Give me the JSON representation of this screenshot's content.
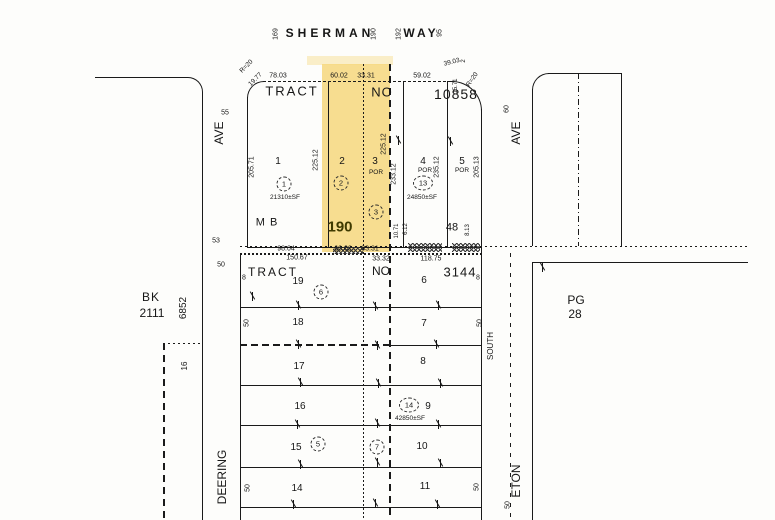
{
  "colors": {
    "highlight": "#F6D77C",
    "line": "#1A1A1A",
    "paper": "#FDFDFB",
    "highlight_number": "#3F3A00"
  },
  "map": {
    "street_labels": [
      {
        "n": "street-sherman",
        "t": "SHERMAN",
        "x": 330,
        "y": 33,
        "s": 12,
        "w": 1,
        "ls": 4
      },
      {
        "n": "street-way",
        "t": "WAY",
        "x": 421,
        "y": 33,
        "s": 12,
        "w": 1,
        "ls": 3
      },
      {
        "n": "address-169",
        "t": "169",
        "x": 276,
        "y": 34,
        "r": -90,
        "s": 7
      },
      {
        "n": "address-190",
        "t": "190",
        "x": 374,
        "y": 34,
        "r": -90,
        "s": 7
      },
      {
        "n": "address-192",
        "t": "192",
        "x": 399,
        "y": 34,
        "r": -90,
        "s": 7
      },
      {
        "n": "address-95",
        "t": "95",
        "x": 440,
        "y": 33,
        "r": -90,
        "s": 7
      },
      {
        "n": "street-ave-left",
        "t": "AVE",
        "x": 219,
        "y": 133,
        "r": -90,
        "s": 12
      },
      {
        "n": "street-width-55",
        "t": "55",
        "x": 225,
        "y": 113,
        "s": 7
      },
      {
        "n": "street-deering",
        "t": "DEERING",
        "x": 222,
        "y": 477,
        "r": -90,
        "s": 12
      },
      {
        "n": "street-ave-right",
        "t": "AVE",
        "x": 516,
        "y": 133,
        "r": -90,
        "s": 12
      },
      {
        "n": "street-width-60",
        "t": "60",
        "x": 507,
        "y": 109,
        "r": -90,
        "s": 7
      },
      {
        "n": "street-eton",
        "t": "ETON",
        "x": 516,
        "y": 481,
        "r": -90,
        "s": 12
      },
      {
        "n": "label-south",
        "t": "SOUTH",
        "x": 491,
        "y": 346,
        "r": -90,
        "s": 8
      },
      {
        "n": "street-width-50-eton",
        "t": "50",
        "x": 508,
        "y": 505,
        "r": -90,
        "s": 7
      }
    ],
    "upper_tract_labels": [
      {
        "n": "upper-tract-word",
        "t": "TRACT",
        "x": 292,
        "y": 91,
        "s": 13,
        "ls": 2
      },
      {
        "n": "upper-tract-no",
        "t": "NO",
        "x": 382,
        "y": 92,
        "s": 13,
        "ls": 1
      },
      {
        "n": "upper-tract-number",
        "t": "10858",
        "x": 456,
        "y": 94,
        "s": 14,
        "ls": 1
      },
      {
        "n": "dim-78-03",
        "t": "78.03",
        "x": 278,
        "y": 76
      },
      {
        "n": "dim-60-02-top",
        "t": "60.02",
        "x": 339,
        "y": 76
      },
      {
        "n": "dim-33-31-top",
        "t": "33.31",
        "x": 366,
        "y": 76
      },
      {
        "n": "dim-59-02",
        "t": "59.02",
        "x": 422,
        "y": 76
      },
      {
        "n": "dim-39-03",
        "t": "39.03",
        "x": 452,
        "y": 63,
        "r": -14,
        "s": 6.5
      },
      {
        "n": "dim-2",
        "t": "2",
        "x": 464,
        "y": 61,
        "r": -90,
        "s": 6
      },
      {
        "n": "dim-r20-ne",
        "t": "R=20",
        "x": 473,
        "y": 80,
        "r": -55,
        "s": 6.5
      },
      {
        "n": "dim-r20-nw",
        "t": "R=20",
        "x": 247,
        "y": 67,
        "r": -45,
        "s": 6.5
      },
      {
        "n": "dim-19-77",
        "t": "19.77",
        "x": 256,
        "y": 80,
        "r": -45,
        "s": 6.5
      },
      {
        "n": "dim-15-71",
        "t": "15.71",
        "x": 456,
        "y": 86,
        "r": -90,
        "s": 6
      },
      {
        "n": "parcel-1-number",
        "t": "1",
        "x": 278,
        "y": 162,
        "s": 10
      },
      {
        "n": "parcel-1-area",
        "t": "21310±SF",
        "x": 285,
        "y": 198,
        "s": 6.5
      },
      {
        "n": "parcel-2-number",
        "t": "2",
        "x": 342,
        "y": 162,
        "s": 10
      },
      {
        "n": "parcel-3-number",
        "t": "3",
        "x": 375,
        "y": 162,
        "s": 10
      },
      {
        "n": "parcel-3-por",
        "t": "POR",
        "x": 376,
        "y": 173,
        "s": 6.5
      },
      {
        "n": "parcel-4-number",
        "t": "4",
        "x": 423,
        "y": 162,
        "s": 10
      },
      {
        "n": "parcel-4-por",
        "t": "POR",
        "x": 425,
        "y": 171,
        "s": 6.5
      },
      {
        "n": "parcel-4-area",
        "t": "24850±SF",
        "x": 422,
        "y": 198,
        "s": 6.5
      },
      {
        "n": "parcel-5-number",
        "t": "5",
        "x": 462,
        "y": 162,
        "s": 10
      },
      {
        "n": "parcel-5-por",
        "t": "POR",
        "x": 462,
        "y": 171,
        "s": 6.5
      },
      {
        "n": "dim-205-71",
        "t": "205.71",
        "x": 252,
        "y": 167,
        "r": -90
      },
      {
        "n": "dim-225-12-a",
        "t": "225.12",
        "x": 316,
        "y": 160,
        "r": -90
      },
      {
        "n": "dim-225-12-b",
        "t": "225.12",
        "x": 384,
        "y": 144,
        "r": -90
      },
      {
        "n": "dim-233-12",
        "t": "233.12",
        "x": 394,
        "y": 174,
        "r": -90
      },
      {
        "n": "dim-235-12",
        "t": "235.12",
        "x": 437,
        "y": 167,
        "r": -90
      },
      {
        "n": "dim-205-13",
        "t": "205.13",
        "x": 477,
        "y": 167,
        "r": -90
      },
      {
        "n": "dim-10-71",
        "t": "10.71",
        "x": 397,
        "y": 231,
        "r": -90,
        "s": 6
      },
      {
        "n": "dim-6-12",
        "t": "6.12",
        "x": 406,
        "y": 229,
        "r": -90,
        "s": 6
      },
      {
        "n": "dim-8-13",
        "t": "8.13",
        "x": 468,
        "y": 230,
        "r": -90,
        "s": 6
      },
      {
        "n": "map-book-page-190",
        "t": "190",
        "x": 340,
        "y": 227,
        "s": 15,
        "w": 1,
        "c": "#3F3A00"
      },
      {
        "n": "map-book-label",
        "t": "M B",
        "x": 267,
        "y": 223,
        "s": 11,
        "ls": 1
      },
      {
        "n": "num-48",
        "t": "48",
        "x": 452,
        "y": 228,
        "s": 11
      },
      {
        "n": "dim-98-04",
        "t": "98.04",
        "x": 286,
        "y": 249
      },
      {
        "n": "dim-60-02-bottom",
        "t": "60.02",
        "x": 343,
        "y": 249
      },
      {
        "n": "dim-33-31-bottom",
        "t": "33.31",
        "x": 370,
        "y": 249
      },
      {
        "n": "num-53",
        "t": "53",
        "x": 216,
        "y": 241,
        "s": 7
      },
      {
        "n": "num-50-left",
        "t": "50",
        "x": 221,
        "y": 265,
        "s": 7
      }
    ],
    "lower_tract_labels": [
      {
        "n": "lower-tract-word",
        "t": "TRACT",
        "x": 273,
        "y": 272,
        "s": 12,
        "ls": 2
      },
      {
        "n": "lower-tract-no",
        "t": "NO",
        "x": 381,
        "y": 271,
        "s": 12
      },
      {
        "n": "lower-tract-number",
        "t": "3144",
        "x": 460,
        "y": 272,
        "s": 13,
        "ls": 1
      },
      {
        "n": "dim-150-67",
        "t": "150.67",
        "x": 297,
        "y": 258
      },
      {
        "n": "dim-33-32",
        "t": "33.32",
        "x": 381,
        "y": 259
      },
      {
        "n": "dim-118-75",
        "t": "118.75",
        "x": 431,
        "y": 259
      },
      {
        "n": "lot-19",
        "t": "19",
        "x": 298,
        "y": 282,
        "s": 10
      },
      {
        "n": "lot-18",
        "t": "18",
        "x": 298,
        "y": 323,
        "s": 10
      },
      {
        "n": "lot-17",
        "t": "17",
        "x": 299,
        "y": 367,
        "s": 10
      },
      {
        "n": "lot-16",
        "t": "16",
        "x": 300,
        "y": 407,
        "s": 10
      },
      {
        "n": "lot-15",
        "t": "15",
        "x": 296,
        "y": 448,
        "s": 10
      },
      {
        "n": "lot-14",
        "t": "14",
        "x": 297,
        "y": 489,
        "s": 10
      },
      {
        "n": "lot-6",
        "t": "6",
        "x": 424,
        "y": 281,
        "s": 10
      },
      {
        "n": "lot-7",
        "t": "7",
        "x": 424,
        "y": 324,
        "s": 10
      },
      {
        "n": "lot-8",
        "t": "8",
        "x": 423,
        "y": 362,
        "s": 10
      },
      {
        "n": "lot-9",
        "t": "9",
        "x": 428,
        "y": 407,
        "s": 10
      },
      {
        "n": "lot-9-area",
        "t": "42850±SF",
        "x": 410,
        "y": 419,
        "s": 6.5
      },
      {
        "n": "lot-10",
        "t": "10",
        "x": 422,
        "y": 447,
        "s": 10
      },
      {
        "n": "lot-11",
        "t": "11",
        "x": 425,
        "y": 487,
        "s": 10
      },
      {
        "n": "edge-8-left",
        "t": "8",
        "x": 244,
        "y": 278,
        "s": 7
      },
      {
        "n": "edge-8-right",
        "t": "8",
        "x": 478,
        "y": 278,
        "s": 7
      },
      {
        "n": "edge-50-a",
        "t": "50",
        "x": 247,
        "y": 323,
        "r": -90,
        "s": 7
      },
      {
        "n": "edge-50-b",
        "t": "50",
        "x": 480,
        "y": 323,
        "r": -90,
        "s": 7
      },
      {
        "n": "edge-50-c",
        "t": "50",
        "x": 248,
        "y": 488,
        "r": -90,
        "s": 7
      },
      {
        "n": "edge-50-d",
        "t": "50",
        "x": 477,
        "y": 487,
        "r": -90,
        "s": 7
      }
    ],
    "reference_labels": [
      {
        "n": "ref-bk",
        "t": "BK",
        "x": 151,
        "y": 297,
        "s": 12,
        "ls": 1
      },
      {
        "n": "ref-bk-number",
        "t": "2111",
        "x": 152,
        "y": 313,
        "s": 12
      },
      {
        "n": "ref-pg",
        "t": "PG",
        "x": 576,
        "y": 300,
        "s": 12
      },
      {
        "n": "ref-pg-number",
        "t": "28",
        "x": 575,
        "y": 314,
        "s": 12
      },
      {
        "n": "ref-6852",
        "t": "6852",
        "x": 184,
        "y": 308,
        "r": -90,
        "s": 10
      },
      {
        "n": "ref-16",
        "t": "16",
        "x": 185,
        "y": 366,
        "r": -90,
        "s": 8
      }
    ],
    "circled_numbers": [
      {
        "n": "circled-1",
        "t": "1",
        "x": 284,
        "y": 184
      },
      {
        "n": "circled-2",
        "t": "2",
        "x": 341,
        "y": 183
      },
      {
        "n": "circled-3",
        "t": "3",
        "x": 376,
        "y": 212
      },
      {
        "n": "circled-13",
        "t": "13",
        "x": 423,
        "y": 183,
        "w": 20
      },
      {
        "n": "circled-6",
        "t": "6",
        "x": 321,
        "y": 292
      },
      {
        "n": "circled-14",
        "t": "14",
        "x": 409,
        "y": 405,
        "w": 20
      },
      {
        "n": "circled-5",
        "t": "5",
        "x": 318,
        "y": 444
      },
      {
        "n": "circled-7",
        "t": "7",
        "x": 377,
        "y": 447
      }
    ]
  }
}
